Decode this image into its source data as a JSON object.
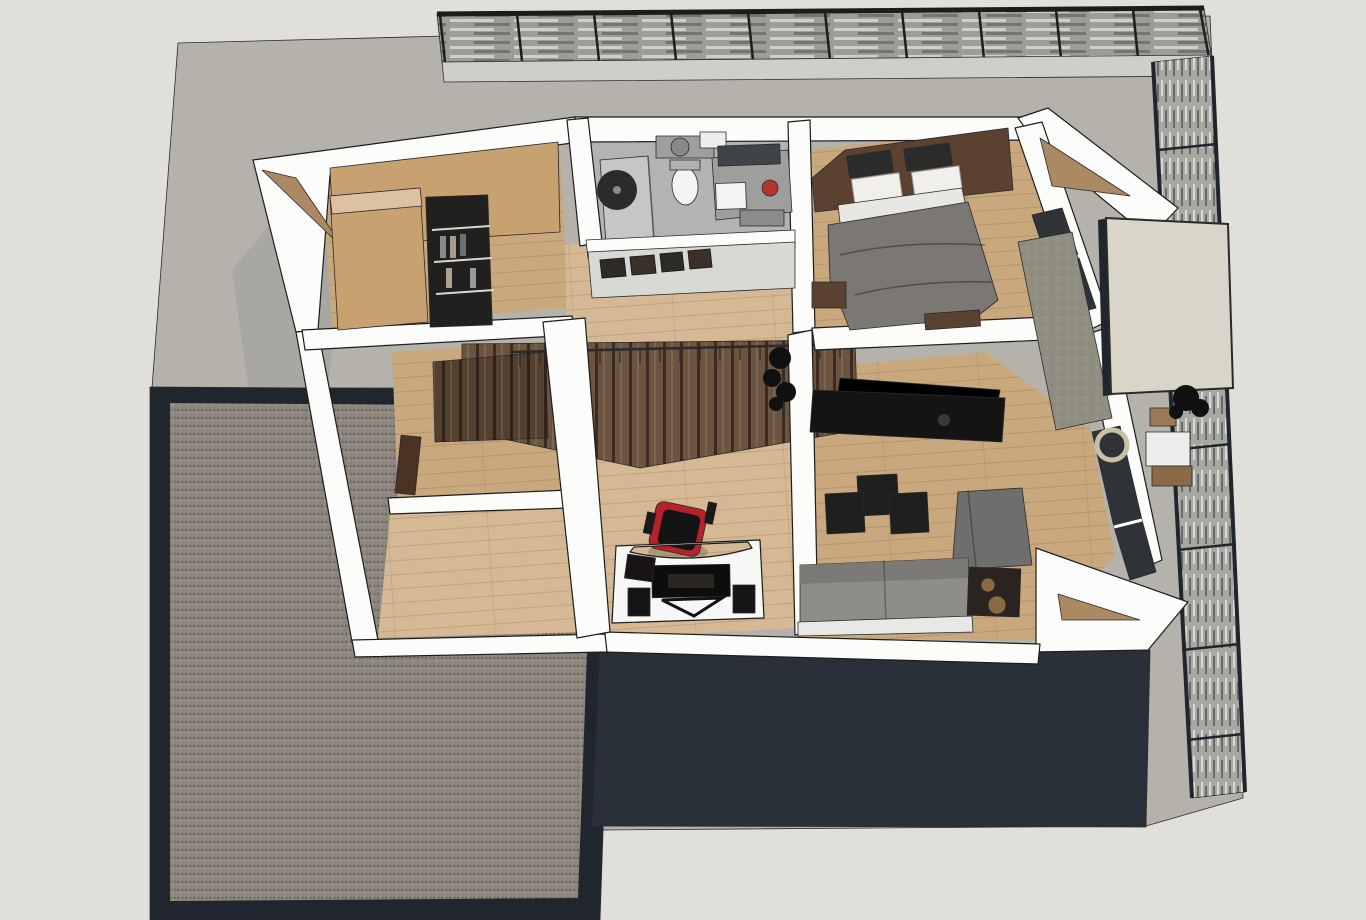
{
  "meta": {
    "app": "3d-architectural-render",
    "view": "top-down cutaway of upper floor",
    "canvas": {
      "width": 1366,
      "height": 920
    }
  },
  "palette": {
    "paper": "#e0dfda",
    "terrain": "#b5b2ab",
    "terrain_shadow": "#a7a5a0",
    "wall_white": "#fcfcfb",
    "wall_shade": "#d8d8d4",
    "wood_floor": "#c9a87e",
    "wood_floor_light": "#d5b894",
    "wardrobe": "#c8a171",
    "wardrobe_top": "#dcc2a0",
    "wood_fascia": "#ab8a63",
    "stair_dark": "#53402f",
    "stair_mid": "#6b5440",
    "bath_floor": "#b3b3b1",
    "shower_floor": "#c6c6c4",
    "fixture_gray": "#9e9e9c",
    "porcelain": "#f4f4f2",
    "mirror_glass": "#3f4448",
    "accent_red": "#b3362e",
    "headboard": "#5a4130",
    "cushion_black": "#2b2b2b",
    "linen": "#f0efec",
    "sheet": "#e9e7e3",
    "duvet": "#7b7772",
    "tv_black": "#141414",
    "pouf_black": "#1f1f1f",
    "sofa_gray": "#8e8d89",
    "chair_gray": "#6e6e6c",
    "table_dark": "#2a2320",
    "bronze": "#8a6a42",
    "desk_white": "#f7f7f6",
    "monitor_black": "#0d0d0d",
    "chair_red": "#b6222a",
    "facade_dark": "#29303a",
    "frame_dark": "#20262e",
    "gravel": "#8d867e",
    "louver_base": "#9c9c98",
    "pergola_fascia": "#cfcfca",
    "screen_base": "#a8a8a2",
    "glass_dark": "#2f3338",
    "concrete": "#8f8e80",
    "beige_panel": "#d9d5c9",
    "balcony_white": "#ececea",
    "wicker": "#8a6a45",
    "plant_black": "#101010",
    "door_wood": "#4a3322",
    "ring_beige": "#c9c0a8"
  },
  "scene": {
    "exterior": {
      "site": "gray terrain plot",
      "pergola": "louvered slat roof strip (north)",
      "screen": "vertical slatted privacy screen (east)",
      "flat_roof": "gravel flat roof (south-west)",
      "facade": "dark clad lower facade (south)",
      "canopy_panel": "beige canopy panel (north-east)",
      "balcony": "east side balcony"
    },
    "rooms": [
      {
        "id": "walk-in-closet",
        "label": "walk-in closet"
      },
      {
        "id": "bathroom",
        "label": "bathroom"
      },
      {
        "id": "bedroom",
        "label": "bedroom"
      },
      {
        "id": "hallway",
        "label": "hallway and stair landing"
      },
      {
        "id": "office",
        "label": "office / study"
      },
      {
        "id": "living-room",
        "label": "tv lounge"
      },
      {
        "id": "spare-room-upper",
        "label": "spare room (upper left)"
      },
      {
        "id": "spare-room-lower",
        "label": "spare room (lower left)"
      }
    ],
    "furniture": {
      "bathroom": [
        "walk-in shower with black rain head",
        "toilet",
        "vanity with sink and mirror",
        "red plant pot",
        "transom window strip"
      ],
      "bedroom": [
        "double bed with gray duvet",
        "dark wood headboard wall",
        "black cushions",
        "white pillows",
        "nightstand",
        "foot bench"
      ],
      "closet": [
        "wardrobe cabinets",
        "dark open shelving unit"
      ],
      "hallway": [
        "dark wood staircase",
        "stair railing",
        "black plant"
      ],
      "office": [
        "white curved desk",
        "monitor",
        "speakers",
        "black and red gaming chair"
      ],
      "living": [
        "black tv sideboard",
        "three black poufs",
        "gray lounge chair",
        "gray sofa",
        "dark side table with speaker",
        "concrete partition"
      ],
      "balcony": [
        "white seat cushions",
        "wicker furniture",
        "beige ring table",
        "black plants"
      ]
    }
  }
}
